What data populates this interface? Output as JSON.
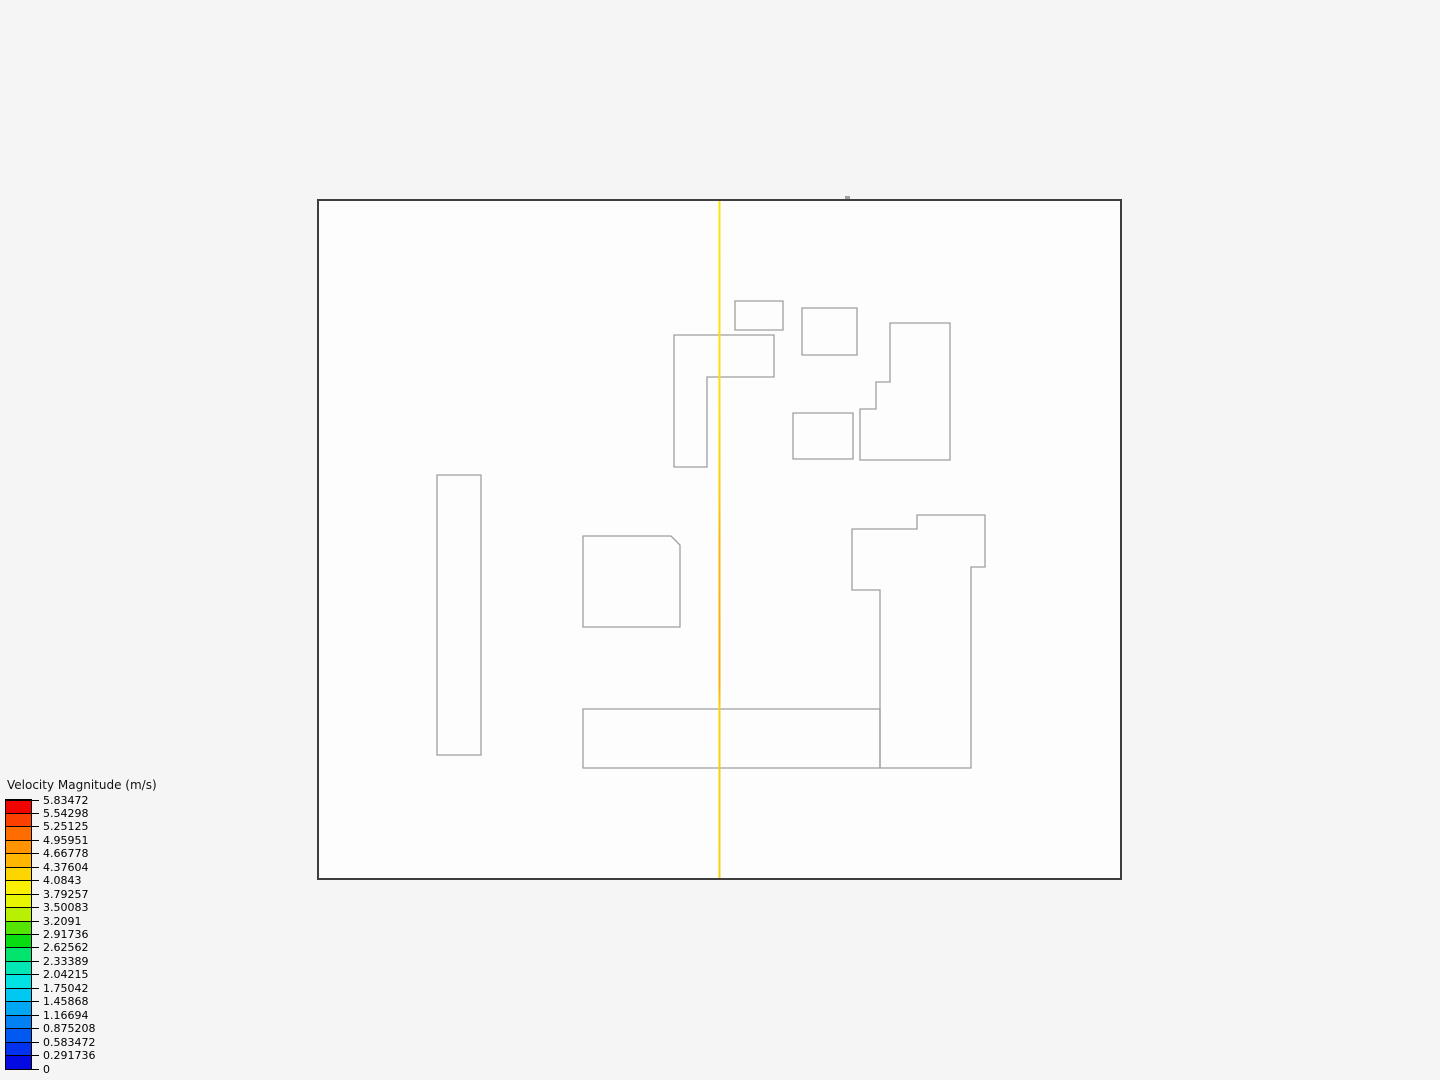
{
  "app": {
    "background": "#f5f5f5"
  },
  "legend": {
    "title": "Velocity Magnitude (m/s)",
    "ticks": [
      "5.83472",
      "5.54298",
      "5.25125",
      "4.95951",
      "4.66778",
      "4.37604",
      "4.0843",
      "3.79257",
      "3.50083",
      "3.2091",
      "2.91736",
      "2.62562",
      "2.33389",
      "2.04215",
      "1.75042",
      "1.45868",
      "1.16694",
      "0.875208",
      "0.583472",
      "0.291736",
      "0"
    ],
    "band_colors": [
      "#f00400",
      "#fb4000",
      "#ff6d00",
      "#ff9300",
      "#ffb600",
      "#fdd500",
      "#fbf002",
      "#e7f501",
      "#b9ef02",
      "#55e502",
      "#07dd11",
      "#02e46e",
      "#02e7b4",
      "#01e3e3",
      "#01c8f0",
      "#02a7f4",
      "#0281f4",
      "#0259f2",
      "#0232ee",
      "#0509e2"
    ],
    "tick_color": "#000000",
    "text_color": "#000000"
  },
  "scene": {
    "domain": {
      "x": 318,
      "y": 200,
      "width": 803,
      "height": 679,
      "border_color": "#3e3e3e",
      "fill": "#fdfdfd"
    },
    "building_outline_color": "#9f9f9f",
    "buildings": [
      {
        "name": "small-rect-north",
        "points": [
          [
            735,
            301
          ],
          [
            783,
            301
          ],
          [
            783,
            330
          ],
          [
            735,
            330
          ]
        ]
      },
      {
        "name": "rect-northeast",
        "points": [
          [
            802,
            308
          ],
          [
            857,
            308
          ],
          [
            857,
            355
          ],
          [
            802,
            355
          ]
        ]
      },
      {
        "name": "l-building",
        "points": [
          [
            674,
            335
          ],
          [
            774,
            335
          ],
          [
            774,
            377
          ],
          [
            707,
            377
          ],
          [
            707,
            467
          ],
          [
            674,
            467
          ]
        ]
      },
      {
        "name": "stepped-building",
        "points": [
          [
            890,
            323
          ],
          [
            950,
            323
          ],
          [
            950,
            460
          ],
          [
            860,
            460
          ],
          [
            860,
            409
          ],
          [
            876,
            409
          ],
          [
            876,
            382
          ],
          [
            890,
            382
          ]
        ]
      },
      {
        "name": "rect-middle",
        "points": [
          [
            793,
            413
          ],
          [
            853,
            413
          ],
          [
            853,
            459
          ],
          [
            793,
            459
          ]
        ]
      },
      {
        "name": "tall-rect-west",
        "points": [
          [
            437,
            475
          ],
          [
            481,
            475
          ],
          [
            481,
            755
          ],
          [
            437,
            755
          ]
        ]
      },
      {
        "name": "chamfered-square",
        "points": [
          [
            583,
            536
          ],
          [
            671,
            536
          ],
          [
            680,
            545
          ],
          [
            680,
            627
          ],
          [
            583,
            627
          ]
        ]
      },
      {
        "name": "big-building-east",
        "points": [
          [
            852,
            529
          ],
          [
            917,
            529
          ],
          [
            917,
            515
          ],
          [
            985,
            515
          ],
          [
            985,
            567
          ],
          [
            971,
            567
          ],
          [
            971,
            768
          ],
          [
            880,
            768
          ],
          [
            880,
            590
          ],
          [
            852,
            590
          ]
        ]
      },
      {
        "name": "long-rect-south",
        "points": [
          [
            583,
            709
          ],
          [
            880,
            709
          ],
          [
            880,
            768
          ],
          [
            583,
            768
          ]
        ]
      }
    ],
    "probe_line": {
      "x": 719.5,
      "y_top": 200,
      "y_bottom": 879,
      "stroke_width": 2,
      "gradient": [
        {
          "offset": "0%",
          "color": "#fae607"
        },
        {
          "offset": "31%",
          "color": "#fcdf02"
        },
        {
          "offset": "44%",
          "color": "#fcca04"
        },
        {
          "offset": "51%",
          "color": "#fab40b"
        },
        {
          "offset": "71%",
          "color": "#faad0e"
        },
        {
          "offset": "75%",
          "color": "#fcd104"
        },
        {
          "offset": "100%",
          "color": "#f0d30a"
        }
      ]
    },
    "top_edge_notch": {
      "x": 845,
      "y": 196,
      "width": 5,
      "height": 3,
      "color": "#9f9f9f"
    }
  }
}
